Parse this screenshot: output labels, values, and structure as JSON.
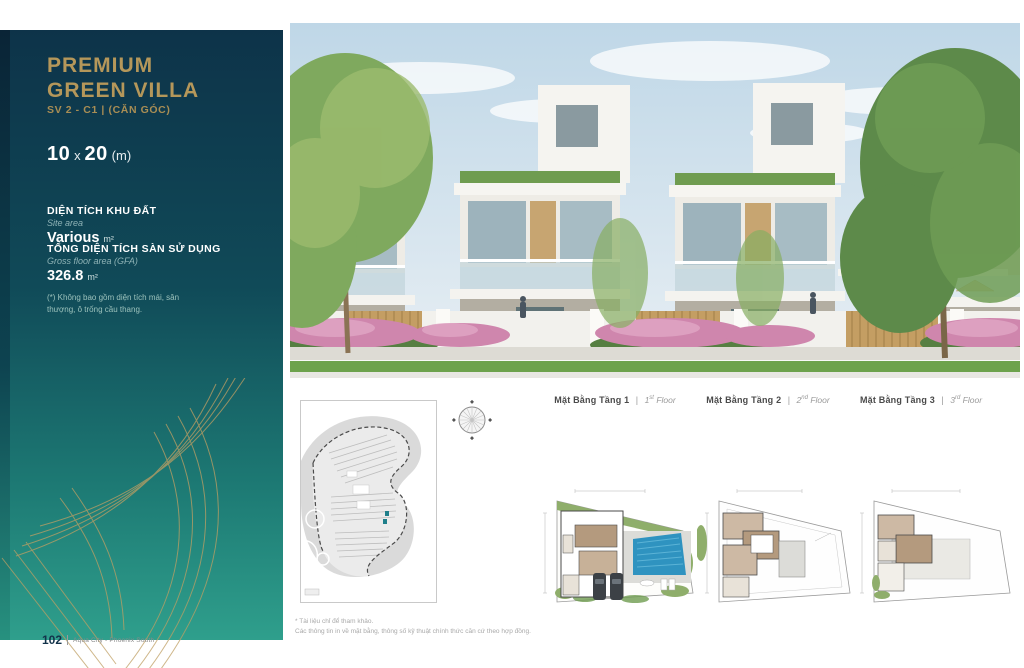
{
  "page": {
    "number": "102",
    "project": "Aqua City - Phoenix South"
  },
  "sidebar": {
    "title_line1": "PREMIUM",
    "title_line2": "GREEN VILLA",
    "unit_code": "SV 2 - C1 | (CĂN GÓC)",
    "size": {
      "width": "10",
      "sep": "x",
      "length": "20",
      "unit": "(m)"
    },
    "site_area": {
      "label_vi": "DIỆN TÍCH KHU ĐẤT",
      "label_en": "Site area",
      "value": "Various",
      "unit": "m²"
    },
    "gfa": {
      "label_vi": "TỔNG DIỆN TÍCH SÀN SỬ DỤNG",
      "label_en": "Gross floor area (GFA)",
      "value": "326.8",
      "unit": "m²"
    },
    "note": "(*) Không bao gồm diện tích mái, sân thượng, ô trống cầu thang."
  },
  "plans": {
    "labels": [
      {
        "vi": "Mặt Bằng Tầng 1",
        "sep": "|",
        "num": "1",
        "sup": "st",
        "word": " Floor"
      },
      {
        "vi": "Mặt Bằng Tầng 2",
        "sep": "|",
        "num": "2",
        "sup": "nd",
        "word": " Floor"
      },
      {
        "vi": "Mặt Bằng Tầng 3",
        "sep": "|",
        "num": "3",
        "sup": "rd",
        "word": " Floor"
      }
    ],
    "disclaimer_line1": "* Tài liệu chỉ để tham khảo.",
    "disclaimer_line2": "Các thông tin in về mặt bằng, thông số kỹ thuật chính thức căn cứ theo hợp đồng."
  },
  "colors": {
    "gold_accent": "#b5975a",
    "panel_top": "#0d3349",
    "panel_bottom": "#2f9f8c",
    "pool_blue": "#2f93c0",
    "hedge_pink": "#d38bb0",
    "map_marker_teal": "#1f7f8a"
  }
}
